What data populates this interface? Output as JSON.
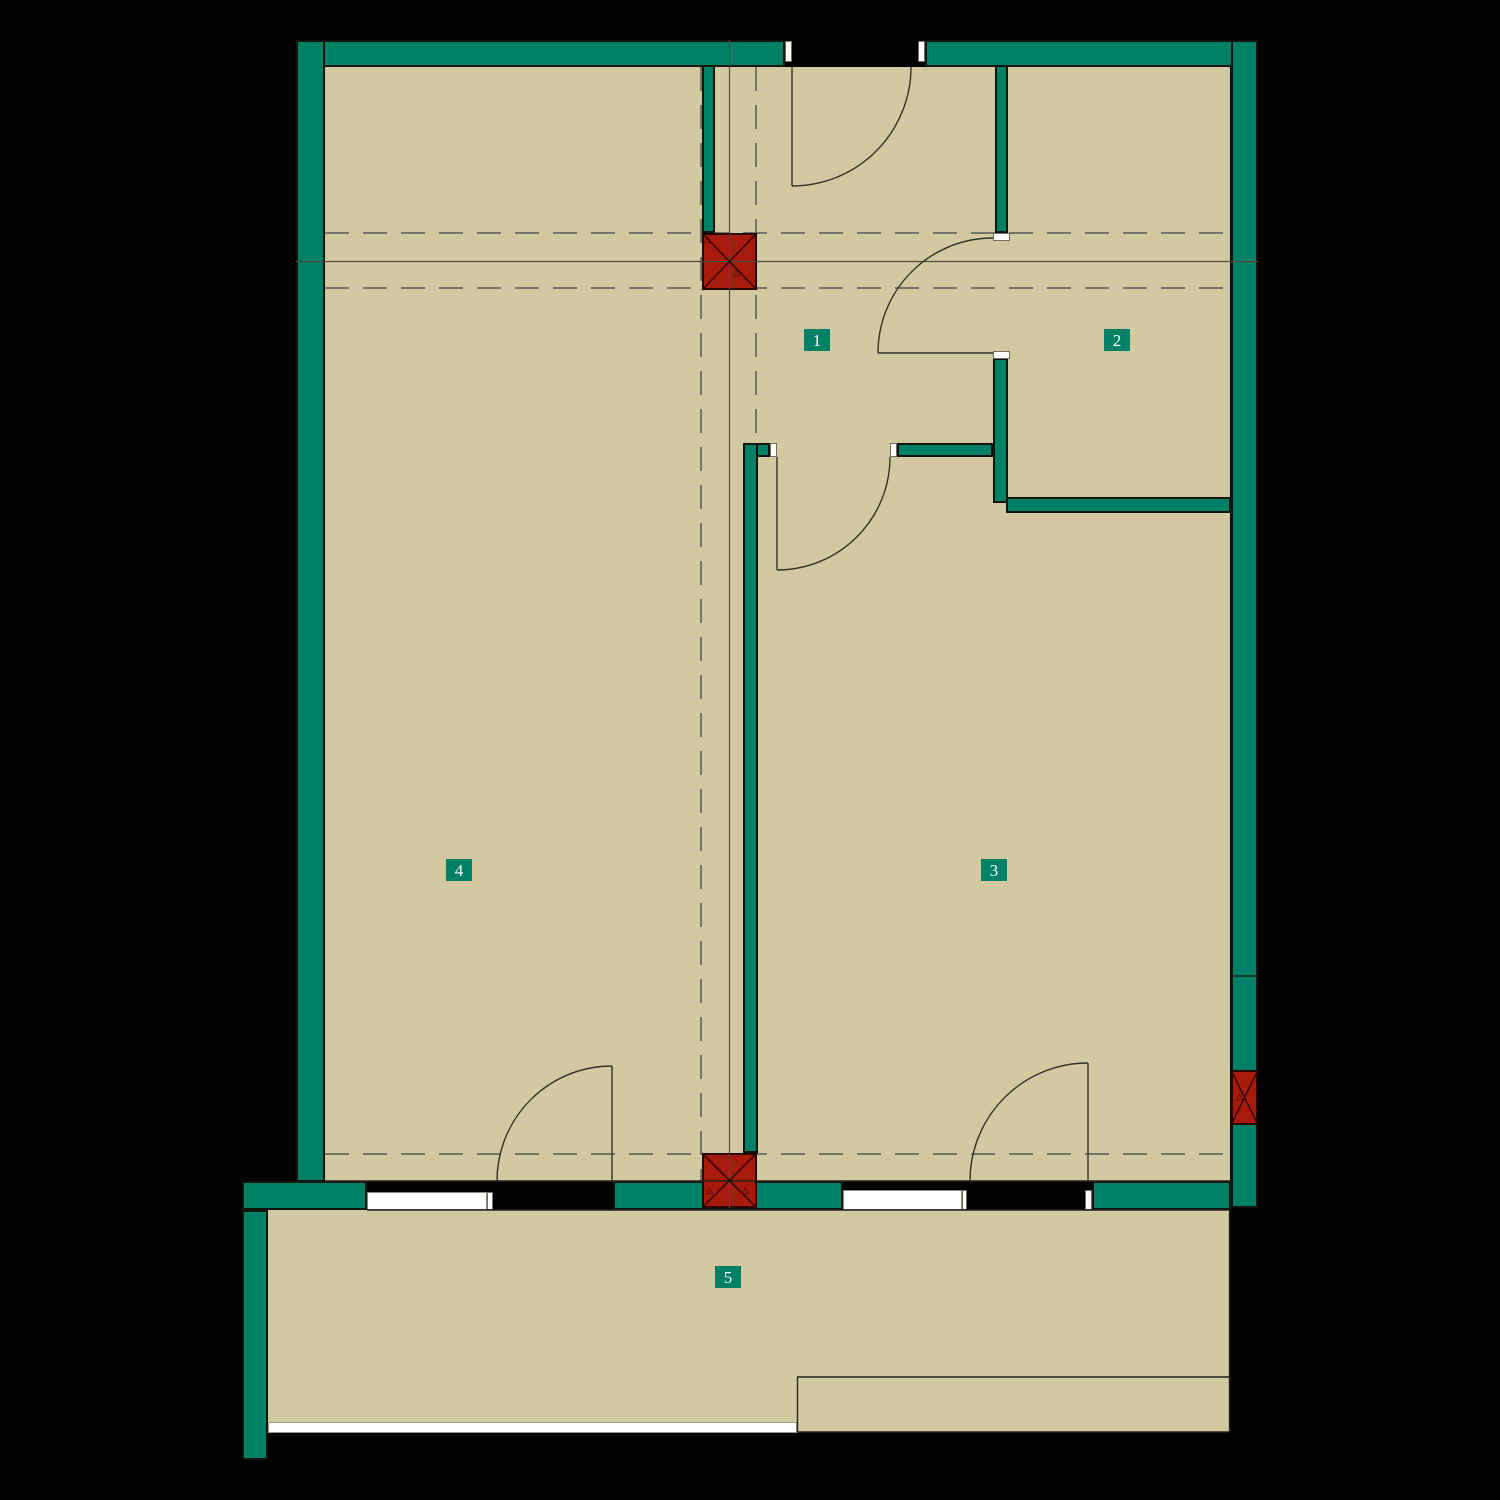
{
  "plan": {
    "type": "apartment-floor-plan",
    "rooms": [
      {
        "number": "1"
      },
      {
        "number": "2"
      },
      {
        "number": "3"
      },
      {
        "number": "4"
      },
      {
        "number": "5"
      }
    ],
    "room_count": 5,
    "features": {
      "doors": 5,
      "windows": 2,
      "columns": 3,
      "balcony_room_number": "5"
    },
    "colors": {
      "background": "#000000",
      "wall": "#008064",
      "floor": "#d2c9a1",
      "column": "#a81b0c",
      "grid_line": "#75756a",
      "axis_line": "#4c4c44",
      "door_line": "#32322a",
      "label_bg": "#008064",
      "label_text": "#ffffff",
      "window": "#ffffff"
    }
  }
}
